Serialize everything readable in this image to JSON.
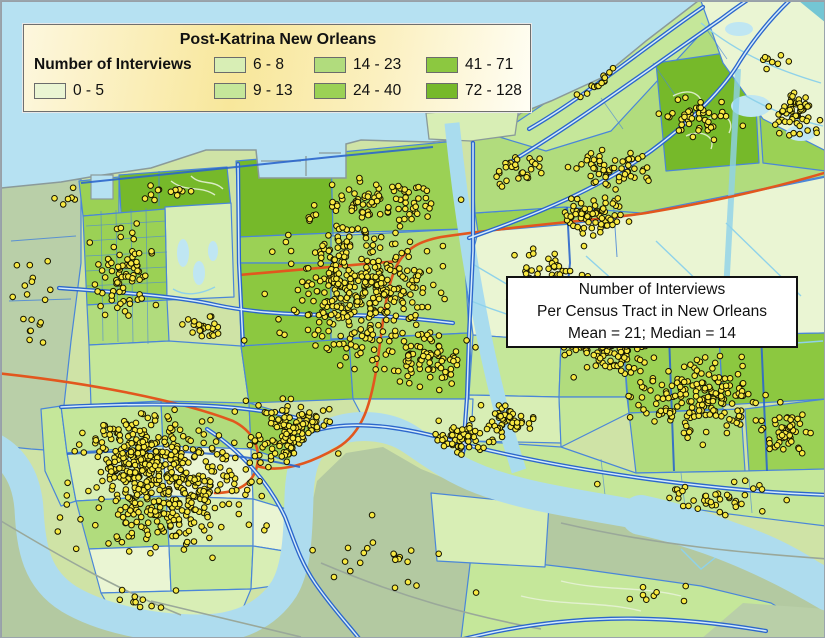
{
  "legend": {
    "title": "Post-Katrina New Orleans",
    "label": "Number of Interviews",
    "classes": [
      {
        "range": "0 - 5",
        "color": "#eaf5d3"
      },
      {
        "range": "6 - 8",
        "color": "#d8eeb5"
      },
      {
        "range": "9 - 13",
        "color": "#c5e79a"
      },
      {
        "range": "14 - 23",
        "color": "#b1dc7d"
      },
      {
        "range": "24 - 40",
        "color": "#9bd155"
      },
      {
        "range": "41 - 71",
        "color": "#8cc840"
      },
      {
        "range": "72 - 128",
        "color": "#76b92a"
      }
    ]
  },
  "annotation": {
    "line1": "Number of Interviews",
    "line2": "Per Census Tract in New Orleans",
    "line3": "Mean = 21; Median = 14"
  },
  "map": {
    "colors": {
      "base": "#cfe3a6",
      "water": "#b6e1f2",
      "river": "#aedcee",
      "canalw": "#a9dcee",
      "cyan": "#8fd2ea",
      "pond": "#bfe6f2",
      "teal": "#74c6d4",
      "gray1": "#b9cfa8",
      "gray2": "#b3c9a1",
      "wb3": "#cde3a2",
      "orange": "#e2571e",
      "blue": "#2b66cc",
      "bluein": "#d5ecfa",
      "thin": "#4a86d8",
      "grayroad": "#9aa89a",
      "shore": "#8a9a9a",
      "squig": "#e6f2d6",
      "dotf": "#f8e943",
      "dots": "#141400"
    },
    "dot_radius": 2.8,
    "dot_clusters": [
      {
        "x": 125,
        "y": 270,
        "rx": 42,
        "ry": 62,
        "n": 75
      },
      {
        "x": 205,
        "y": 325,
        "rx": 40,
        "ry": 20,
        "n": 25
      },
      {
        "x": 30,
        "y": 300,
        "rx": 30,
        "ry": 75,
        "n": 18
      },
      {
        "x": 70,
        "y": 195,
        "rx": 25,
        "ry": 14,
        "n": 6
      },
      {
        "x": 170,
        "y": 190,
        "rx": 50,
        "ry": 12,
        "n": 12
      },
      {
        "x": 360,
        "y": 290,
        "rx": 105,
        "ry": 95,
        "n": 380
      },
      {
        "x": 378,
        "y": 200,
        "rx": 95,
        "ry": 30,
        "n": 85
      },
      {
        "x": 545,
        "y": 285,
        "rx": 60,
        "ry": 50,
        "n": 90
      },
      {
        "x": 515,
        "y": 168,
        "rx": 40,
        "ry": 26,
        "n": 30
      },
      {
        "x": 592,
        "y": 215,
        "rx": 45,
        "ry": 26,
        "n": 70
      },
      {
        "x": 612,
        "y": 350,
        "rx": 48,
        "ry": 38,
        "n": 80
      },
      {
        "x": 612,
        "y": 168,
        "rx": 55,
        "ry": 30,
        "n": 55
      },
      {
        "x": 700,
        "y": 118,
        "rx": 55,
        "ry": 30,
        "n": 45
      },
      {
        "x": 795,
        "y": 112,
        "rx": 30,
        "ry": 33,
        "n": 55
      },
      {
        "x": 598,
        "y": 52,
        "rx": 38,
        "ry": 24,
        "n": 14
      },
      {
        "x": 768,
        "y": 62,
        "rx": 24,
        "ry": 11,
        "n": 8
      },
      {
        "x": 700,
        "y": 398,
        "rx": 88,
        "ry": 48,
        "n": 170
      },
      {
        "x": 788,
        "y": 432,
        "rx": 34,
        "ry": 30,
        "n": 45
      },
      {
        "x": 170,
        "y": 480,
        "rx": 125,
        "ry": 90,
        "n": 420
      },
      {
        "x": 130,
        "y": 452,
        "rx": 60,
        "ry": 48,
        "n": 120
      },
      {
        "x": 298,
        "y": 432,
        "rx": 55,
        "ry": 40,
        "n": 130
      },
      {
        "x": 452,
        "y": 438,
        "rx": 60,
        "ry": 26,
        "n": 55
      },
      {
        "x": 510,
        "y": 420,
        "rx": 42,
        "ry": 24,
        "n": 45
      },
      {
        "x": 565,
        "y": 338,
        "rx": 28,
        "ry": 26,
        "n": 30
      },
      {
        "x": 690,
        "y": 498,
        "rx": 125,
        "ry": 26,
        "n": 40
      },
      {
        "x": 430,
        "y": 360,
        "rx": 52,
        "ry": 38,
        "n": 70
      },
      {
        "x": 390,
        "y": 560,
        "rx": 110,
        "ry": 50,
        "n": 22
      },
      {
        "x": 130,
        "y": 602,
        "rx": 80,
        "ry": 24,
        "n": 10
      },
      {
        "x": 660,
        "y": 598,
        "rx": 88,
        "ry": 22,
        "n": 8
      }
    ]
  }
}
